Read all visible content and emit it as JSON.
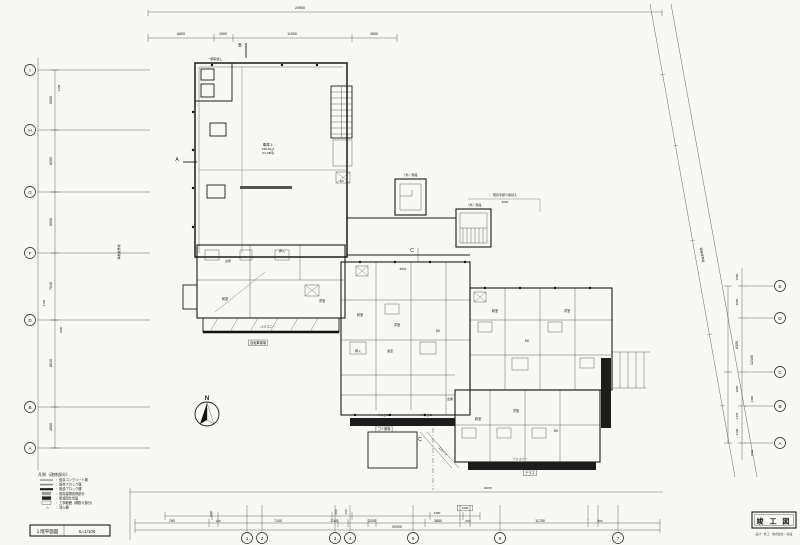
{
  "sheet": {
    "title_block": {
      "title": "竣 工 図",
      "subtitle": "設計・施工　株式会社○○建設"
    },
    "sheet_label": "１階平面図",
    "scale": "S=1/100"
  },
  "north": {
    "label": "N"
  },
  "legend": {
    "header": "凡例（改修部分）",
    "items": [
      {
        "symbol": "double-line",
        "label": "既存コンクリート塀"
      },
      {
        "symbol": "gray-line",
        "label": "既存ブロック塀"
      },
      {
        "symbol": "thick-line",
        "label": "新設ブロック塀"
      },
      {
        "symbol": "hatch-box",
        "label": "既存建物改修部分"
      },
      {
        "symbol": "solid-box",
        "label": "新設間仕切壁"
      },
      {
        "symbol": "open-box",
        "label": "工事範囲（網掛け部分）"
      },
      {
        "symbol": "triangle",
        "label": "消火器"
      }
    ]
  },
  "garage_label": {
    "name": "車庫１",
    "area": "236.32㎡",
    "tsubo": "(71.48坪)"
  },
  "grid": {
    "left": [
      {
        "label": "I",
        "y": 70
      },
      {
        "label": "H",
        "y": 130
      },
      {
        "label": "G",
        "y": 192
      },
      {
        "label": "F",
        "y": 253
      },
      {
        "label": "D",
        "y": 320
      },
      {
        "label": "B",
        "y": 407
      },
      {
        "label": "A",
        "y": 448
      }
    ],
    "right": [
      {
        "label": "E",
        "y": 286
      },
      {
        "label": "D",
        "y": 318
      },
      {
        "label": "C",
        "y": 372
      },
      {
        "label": "B",
        "y": 406
      },
      {
        "label": "A",
        "y": 443
      }
    ],
    "bottom": [
      {
        "label": "1",
        "x": 247
      },
      {
        "label": "2",
        "x": 262
      },
      {
        "label": "3",
        "x": 335
      },
      {
        "label": "4",
        "x": 350
      },
      {
        "label": "5",
        "x": 413
      },
      {
        "label": "6",
        "x": 500
      },
      {
        "label": "7",
        "x": 618
      }
    ]
  },
  "dimensions": [
    {
      "t": "24900",
      "x": 300,
      "y": 9,
      "s": 3.6
    },
    {
      "t": "6600",
      "x": 181,
      "y": 35,
      "s": 3.6
    },
    {
      "t": "1900",
      "x": 223,
      "y": 35,
      "s": 3.6
    },
    {
      "t": "11900",
      "x": 292,
      "y": 35,
      "s": 3.6
    },
    {
      "t": "4500",
      "x": 374,
      "y": 35,
      "s": 3.6
    },
    {
      "t": "6000",
      "x": 52,
      "y": 100,
      "r": -90,
      "s": 3.6
    },
    {
      "t": "6000",
      "x": 52,
      "y": 161,
      "r": -90,
      "s": 3.6
    },
    {
      "t": "6000",
      "x": 52,
      "y": 222,
      "r": -90,
      "s": 3.6
    },
    {
      "t": "7040",
      "x": 52,
      "y": 286,
      "r": -90,
      "s": 3.6
    },
    {
      "t": "8040",
      "x": 52,
      "y": 363,
      "r": -90,
      "s": 3.6
    },
    {
      "t": "4500",
      "x": 52,
      "y": 427,
      "r": -90,
      "s": 3.6
    },
    {
      "t": "2100",
      "x": 60,
      "y": 88,
      "r": -90,
      "s": 3
    },
    {
      "t": "1140",
      "x": 45,
      "y": 303,
      "r": -90,
      "s": 3
    },
    {
      "t": "1500",
      "x": 62,
      "y": 330,
      "r": -90,
      "s": 3
    },
    {
      "t": "1500",
      "x": 738,
      "y": 277,
      "r": -90,
      "s": 3
    },
    {
      "t": "2000",
      "x": 738,
      "y": 302,
      "r": -90,
      "s": 3
    },
    {
      "t": "6300",
      "x": 738,
      "y": 345,
      "r": -90,
      "s": 3.6
    },
    {
      "t": "1800",
      "x": 738,
      "y": 389,
      "r": -90,
      "s": 3
    },
    {
      "t": "1470",
      "x": 738,
      "y": 416,
      "r": -90,
      "s": 3
    },
    {
      "t": "4190",
      "x": 738,
      "y": 432,
      "r": -90,
      "s": 3
    },
    {
      "t": "12100",
      "x": 753,
      "y": 360,
      "r": -90,
      "s": 3.6
    },
    {
      "t": "2400",
      "x": 753,
      "y": 399,
      "r": -90,
      "s": 3
    },
    {
      "t": "1500",
      "x": 753,
      "y": 453,
      "r": -90,
      "s": 3
    },
    {
      "t": "760",
      "x": 172,
      "y": 522,
      "s": 3.6
    },
    {
      "t": "130",
      "x": 218,
      "y": 522,
      "s": 3
    },
    {
      "t": "7100",
      "x": 278,
      "y": 522,
      "s": 3.6
    },
    {
      "t": "1160",
      "x": 334,
      "y": 522,
      "s": 3.6
    },
    {
      "t": "3200",
      "x": 372,
      "y": 522,
      "s": 3.6
    },
    {
      "t": "3850",
      "x": 438,
      "y": 522,
      "s": 3.6
    },
    {
      "t": "400",
      "x": 468,
      "y": 522,
      "s": 3
    },
    {
      "t": "11750",
      "x": 540,
      "y": 522,
      "s": 3.6
    },
    {
      "t": "800",
      "x": 600,
      "y": 522,
      "s": 3
    },
    {
      "t": "1370",
      "x": 212,
      "y": 514,
      "r": -90,
      "s": 3
    },
    {
      "t": "1280",
      "x": 437,
      "y": 514,
      "s": 3
    },
    {
      "t": "600",
      "x": 337,
      "y": 512,
      "r": -90,
      "s": 3
    },
    {
      "t": "600",
      "x": 347,
      "y": 512,
      "r": -90,
      "s": 3
    },
    {
      "t": "1000",
      "x": 465,
      "y": 509,
      "s": 3,
      "boxed": true
    },
    {
      "t": "34070",
      "x": 488,
      "y": 489,
      "s": 3
    },
    {
      "t": "50900",
      "x": 397,
      "y": 528,
      "s": 3.4
    },
    {
      "t": "8697",
      "x": 403,
      "y": 270,
      "s": 3
    },
    {
      "t": "3000",
      "x": 505,
      "y": 203,
      "s": 3
    }
  ],
  "room_labels": [
    {
      "t": "バルコニー",
      "x": 268,
      "y": 328,
      "s": 3.2
    },
    {
      "t": "バルコニー",
      "x": 385,
      "y": 416,
      "s": 3
    },
    {
      "t": "バルコニー",
      "x": 428,
      "y": 416,
      "s": 3
    },
    {
      "t": "バルコニー",
      "x": 520,
      "y": 460,
      "s": 3
    },
    {
      "t": "自転車置場",
      "x": 258,
      "y": 344,
      "s": 3.2,
      "boxed": true
    },
    {
      "t": "ゴミ置場",
      "x": 384,
      "y": 430,
      "s": 3.2,
      "boxed": true
    },
    {
      "t": "テラス",
      "x": 530,
      "y": 474,
      "s": 3.2,
      "boxed": true
    },
    {
      "t": "和室",
      "x": 360,
      "y": 316,
      "s": 3.2
    },
    {
      "t": "洋室",
      "x": 397,
      "y": 326,
      "s": 3.2
    },
    {
      "t": "DK",
      "x": 438,
      "y": 332,
      "s": 3.2
    },
    {
      "t": "押入",
      "x": 358,
      "y": 352,
      "s": 3
    },
    {
      "t": "浴室",
      "x": 390,
      "y": 352,
      "s": 3
    },
    {
      "t": "和室",
      "x": 495,
      "y": 312,
      "s": 3.2
    },
    {
      "t": "DK",
      "x": 527,
      "y": 342,
      "s": 3.2
    },
    {
      "t": "洋室",
      "x": 567,
      "y": 312,
      "s": 3.2
    },
    {
      "t": "和室",
      "x": 478,
      "y": 420,
      "s": 3.2
    },
    {
      "t": "洋室",
      "x": 516,
      "y": 412,
      "s": 3.2
    },
    {
      "t": "DK",
      "x": 556,
      "y": 432,
      "s": 3.2
    },
    {
      "t": "玄関",
      "x": 450,
      "y": 400,
      "s": 3
    },
    {
      "t": "台所",
      "x": 228,
      "y": 262,
      "s": 3
    },
    {
      "t": "和室",
      "x": 225,
      "y": 300,
      "s": 3.2
    },
    {
      "t": "洋室",
      "x": 322,
      "y": 302,
      "s": 3.2
    },
    {
      "t": "押入",
      "x": 282,
      "y": 252,
      "s": 3
    },
    {
      "t": "EV",
      "x": 342,
      "y": 182,
      "s": 3
    }
  ],
  "annotations": [
    {
      "t": "一部取壊し",
      "x": 215,
      "y": 60,
      "s": 3
    },
    {
      "t": "既存手摺り取替え",
      "x": 505,
      "y": 196,
      "s": 3
    },
    {
      "t": "（外）階段",
      "x": 410,
      "y": 176,
      "s": 3
    },
    {
      "t": "（外）階段",
      "x": 474,
      "y": 206,
      "s": 3
    },
    {
      "t": "隣地境界線",
      "x": 120,
      "y": 252,
      "r": -90,
      "s": 3
    },
    {
      "t": "道路境界線",
      "x": 701,
      "y": 255,
      "r": 80,
      "s": 3
    },
    {
      "t": "スロープ",
      "x": 442,
      "y": 452,
      "r": 48,
      "s": 3
    },
    {
      "t": "B",
      "x": 240,
      "y": 47,
      "s": 5
    },
    {
      "t": "C",
      "x": 412,
      "y": 252,
      "s": 5
    },
    {
      "t": "C",
      "x": 420,
      "y": 441,
      "s": 5
    },
    {
      "t": "A",
      "x": 177,
      "y": 161,
      "s": 5
    }
  ]
}
